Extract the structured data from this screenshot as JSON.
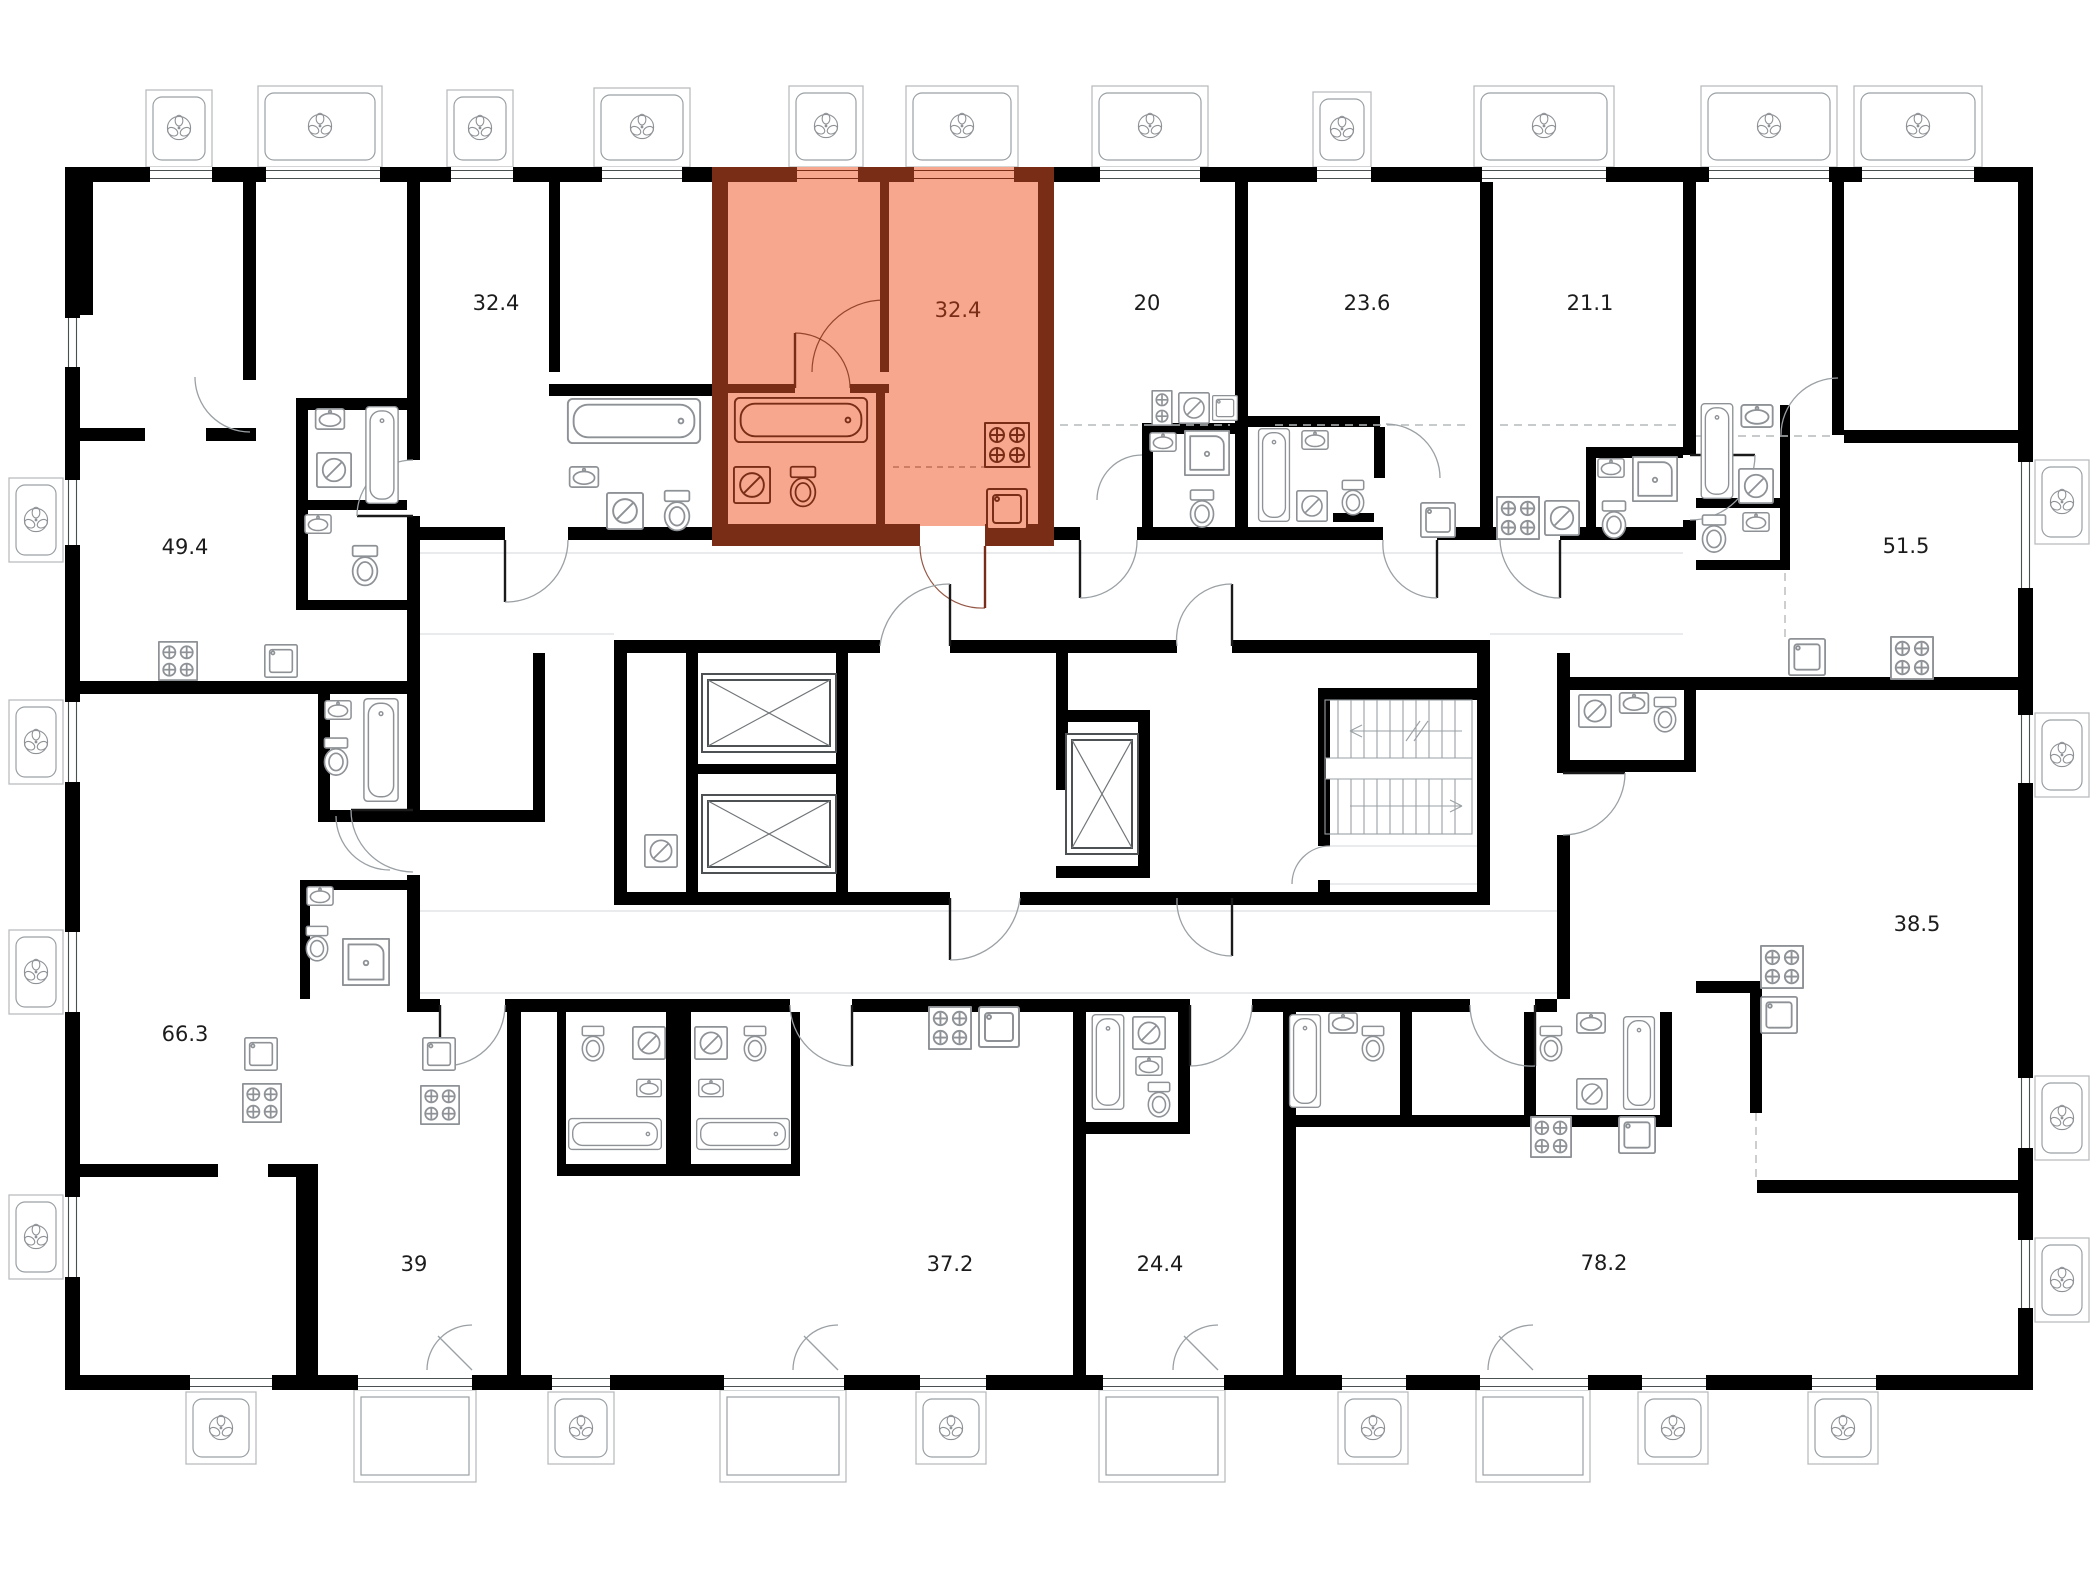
{
  "plan": {
    "type": "residential-floor-plan",
    "colors": {
      "wall": "#000000",
      "highlight_fill": "#f6a78d",
      "highlight_wall": "#7a2d16",
      "fixture_line": "#8e9296",
      "label": "#1c1c1c"
    },
    "icons": {
      "fan": "fan-icon",
      "elevator": "elevator-crossed-box-icon",
      "stairs": "stairs-run-icon",
      "bathtub": "bathtub-icon",
      "toilet": "toilet-icon",
      "sink": "sink-icon",
      "washer": "washing-machine-icon",
      "stove": "stove-burners-icon",
      "kitchen_sink": "kitchen-sink-icon",
      "shower": "shower-icon"
    },
    "units": [
      {
        "id": "unit-32-4-a",
        "area": "32.4",
        "highlighted": false
      },
      {
        "id": "unit-32-4-b",
        "area": "32.4",
        "highlighted": true
      },
      {
        "id": "unit-20",
        "area": "20",
        "highlighted": false
      },
      {
        "id": "unit-23-6",
        "area": "23.6",
        "highlighted": false
      },
      {
        "id": "unit-21-1",
        "area": "21.1",
        "highlighted": false
      },
      {
        "id": "unit-49-4",
        "area": "49.4",
        "highlighted": false
      },
      {
        "id": "unit-51-5",
        "area": "51.5",
        "highlighted": false
      },
      {
        "id": "unit-66-3",
        "area": "66.3",
        "highlighted": false
      },
      {
        "id": "unit-38-5",
        "area": "38.5",
        "highlighted": false
      },
      {
        "id": "unit-39",
        "area": "39",
        "highlighted": false
      },
      {
        "id": "unit-37-2",
        "area": "37.2",
        "highlighted": false
      },
      {
        "id": "unit-24-4",
        "area": "24.4",
        "highlighted": false
      },
      {
        "id": "unit-78-2",
        "area": "78.2",
        "highlighted": false
      }
    ]
  }
}
